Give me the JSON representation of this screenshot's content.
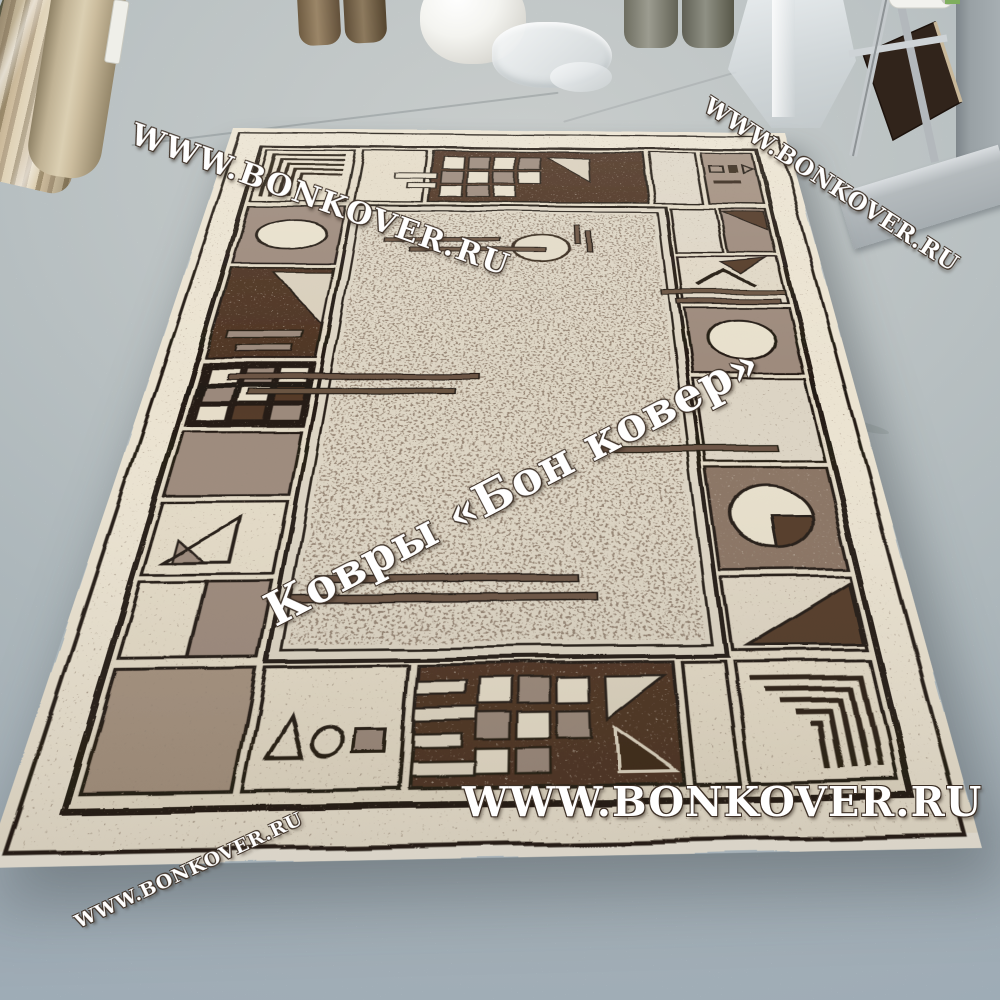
{
  "watermarks": {
    "top_left": "WWW.BONKOVER.RU",
    "top_right": "WWW.BONKOVER.RU",
    "center": "Ковры «Бон ковер»",
    "bottom_center": "WWW.BONKOVER.RU",
    "bottom_left": "WWW.BONKOVER.RU"
  },
  "colors": {
    "floor": "#b3bcc0",
    "rug_cream": "#e6ddc9",
    "rug_field": "#ddd5c4",
    "rug_taupe": "#9d8a7c",
    "rug_brown": "#8a7463",
    "rug_dark_brown": "#4e3423",
    "rug_outline": "#241c14",
    "watermark_fill": "#ffffff",
    "watermark_outline": "#3e3127"
  }
}
